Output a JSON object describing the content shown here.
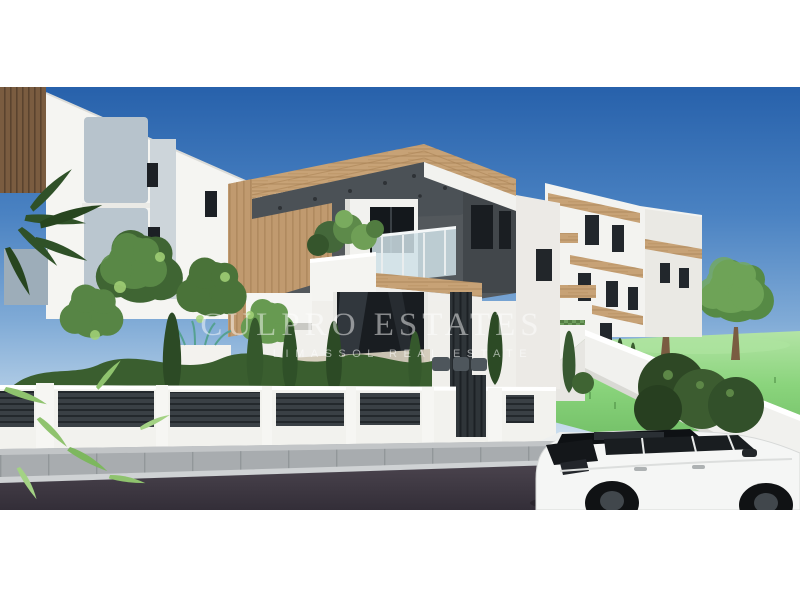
{
  "image": {
    "kind": "3D architectural rendering",
    "description": "Modern residential development with white and charcoal facades, timber cladding, balcony with glass railing and planter, landscaped garden with cypress trees, white boundary fence with dark slatted panels, green lawn and a white SUV parked on the street"
  },
  "watermark": {
    "brand": "CULPRO ESTATES",
    "tagline": "LIMASSOL REAL ESTATE"
  },
  "palette": {
    "sky_top": "#2761ab",
    "sky_horizon": "#edf3f7",
    "wood": "#c7a276",
    "charcoal_wall": "#4a5055",
    "white_wall": "#f3f3f0",
    "panel_blue_gray": "#b7c3cc",
    "fence_slats": "#383e43",
    "lawn_green": "#7dcb70",
    "foliage_green": "#4e7a3c",
    "road_asphalt": "#423c44",
    "sidewalk_gray": "#a8acaf",
    "car_body": "#f5f6f5",
    "car_glass": "#15181b"
  }
}
